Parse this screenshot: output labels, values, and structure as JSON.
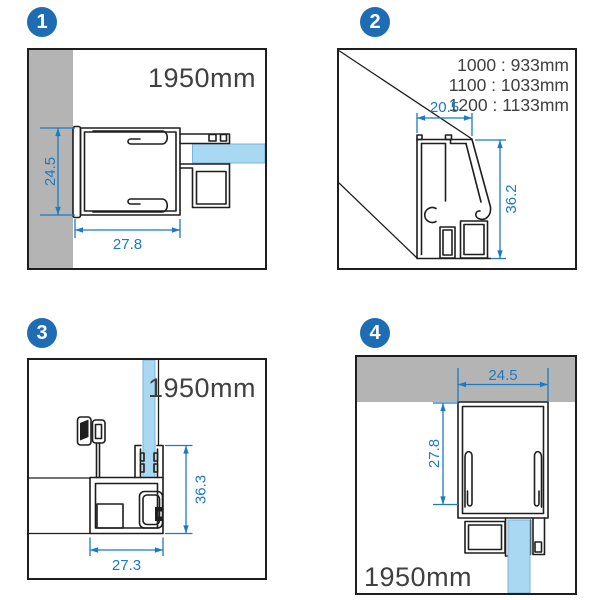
{
  "colors": {
    "badge_blue": "#1d6cb4",
    "dimension_blue": "#1c79c4",
    "glass_blue": "#a9d8f2",
    "wall_gray": "#b4b4b4",
    "line_black": "#1e1e1e",
    "label_gray": "#404040"
  },
  "panels": {
    "p1": {
      "badge": "1",
      "height_label": "1950mm",
      "dim_depth": "24.5",
      "dim_width": "27.8"
    },
    "p2": {
      "badge": "2",
      "size_options": [
        "1000 : 933mm",
        "1100 : 1033mm",
        "1200 : 1133mm"
      ],
      "dim_top": "20.5",
      "dim_height": "36.2"
    },
    "p3": {
      "badge": "3",
      "height_label": "1950mm",
      "dim_height": "36.3",
      "dim_width": "27.3"
    },
    "p4": {
      "badge": "4",
      "height_label": "1950mm",
      "dim_top": "24.5",
      "dim_side": "27.8"
    }
  }
}
